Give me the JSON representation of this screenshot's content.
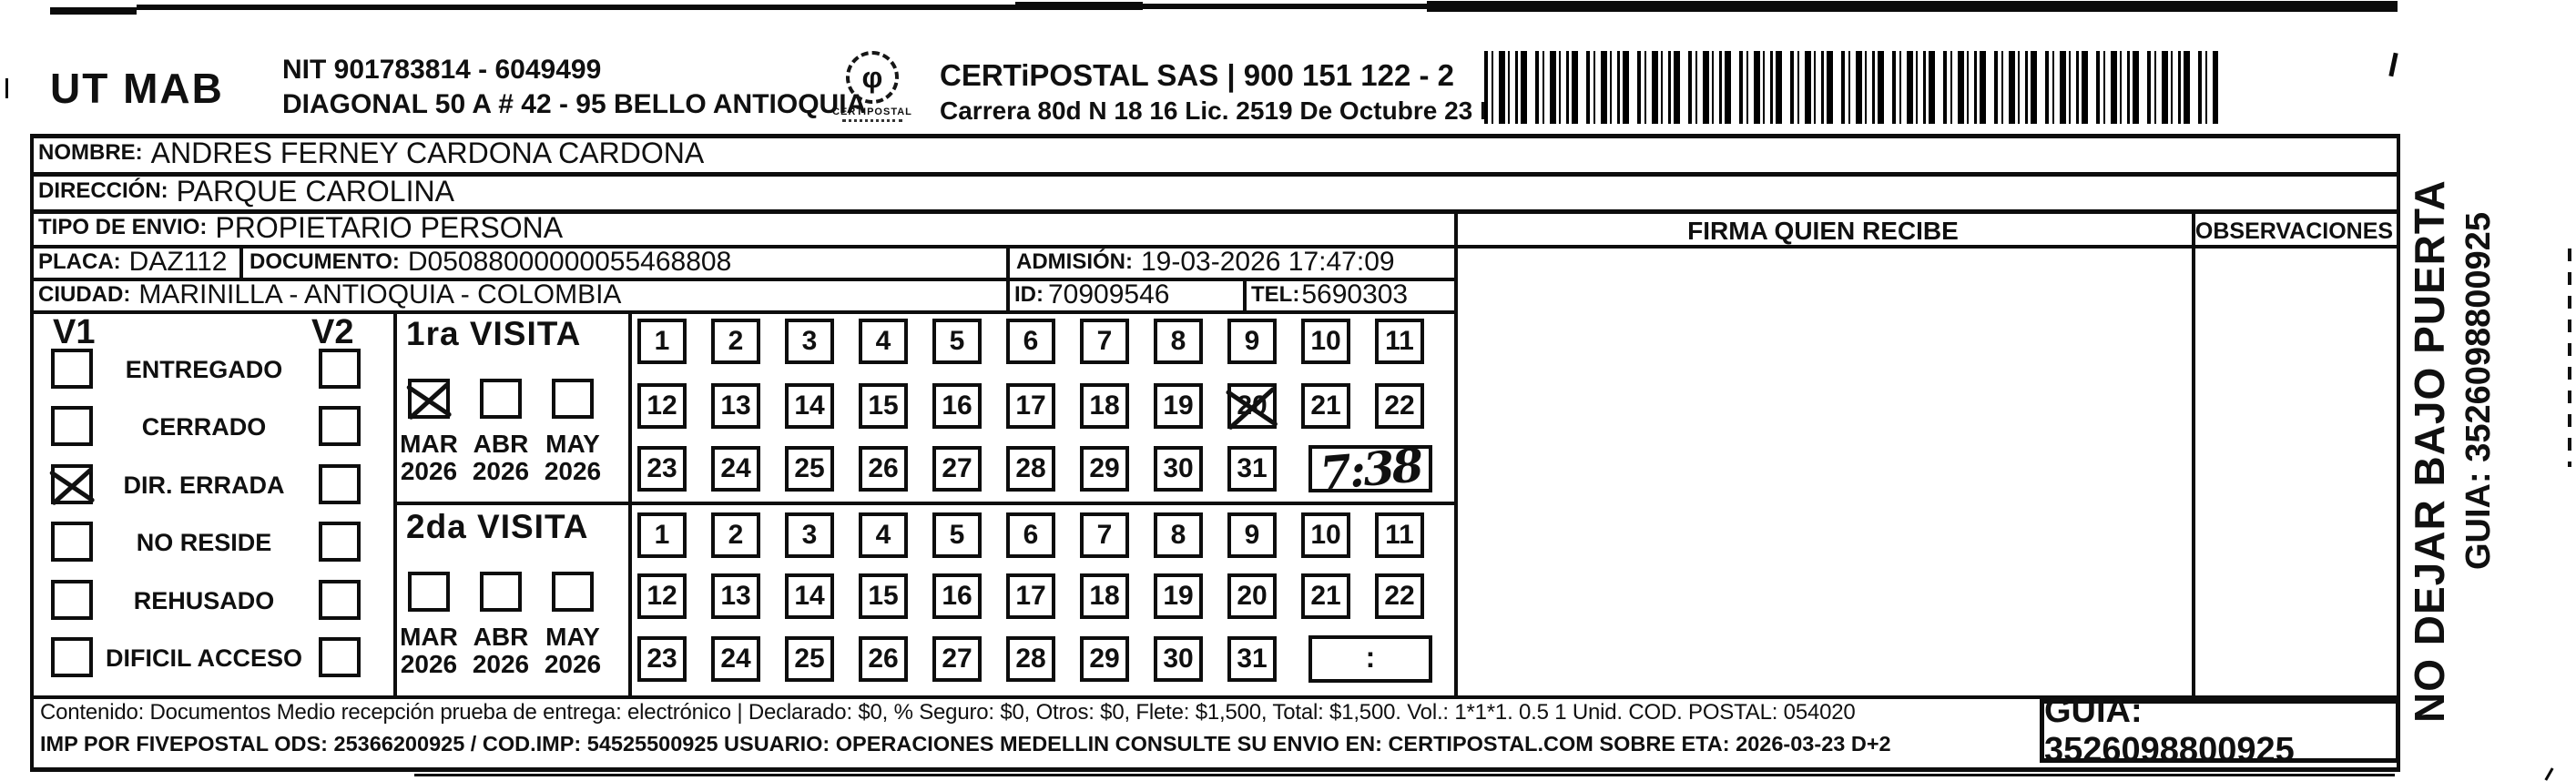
{
  "header": {
    "sender": "UT MAB",
    "nit": "NIT 901783814 - 6049499",
    "sender_address": "DIAGONAL 50 A # 42 - 95  BELLO  ANTIOQUIA",
    "logo_text": "CERTIPOSTAL",
    "company": "CERTiPOSTAL SAS | 900 151 122 - 2",
    "company_address": "Carrera 80d N 18 16  Lic. 2519 De Octubre 23 De 2015"
  },
  "fields": {
    "nombre": {
      "label": "NOMBRE:",
      "value": "ANDRES FERNEY CARDONA CARDONA"
    },
    "direccion": {
      "label": "DIRECCIÓN:",
      "value": "PARQUE CAROLINA"
    },
    "tipo_envio": {
      "label": "TIPO DE ENVIO:",
      "value": "PROPIETARIO PERSONA"
    },
    "placa": {
      "label": "PLACA:",
      "value": "DAZ112"
    },
    "documento": {
      "label": "DOCUMENTO:",
      "value": "D05088000000055468808"
    },
    "admision": {
      "label": "ADMISIÓN:",
      "value": "19-03-2026 17:47:09"
    },
    "ciudad": {
      "label": "CIUDAD:",
      "value": "MARINILLA - ANTIOQUIA - COLOMBIA"
    },
    "id": {
      "label": "ID:",
      "value": "70909546"
    },
    "tel": {
      "label": "TEL:",
      "value": "5690303"
    }
  },
  "columns": {
    "firma": "FIRMA QUIEN RECIBE",
    "observaciones": "OBSERVACIONES"
  },
  "status_panel": {
    "visit1_header": "V1",
    "visit2_header": "V2",
    "rows": [
      {
        "label": "ENTREGADO",
        "v1_checked": false,
        "v2_checked": false
      },
      {
        "label": "CERRADO",
        "v1_checked": false,
        "v2_checked": false
      },
      {
        "label": "DIR. ERRADA",
        "v1_checked": true,
        "v2_checked": false
      },
      {
        "label": "NO RESIDE",
        "v1_checked": false,
        "v2_checked": false
      },
      {
        "label": "REHUSADO",
        "v1_checked": false,
        "v2_checked": false
      },
      {
        "label": "DIFICIL ACCESO",
        "v1_checked": false,
        "v2_checked": false
      }
    ]
  },
  "visits": [
    {
      "title": "1ra VISITA",
      "months": [
        {
          "month": "MAR",
          "year": "2026",
          "checked": true
        },
        {
          "month": "ABR",
          "year": "2026",
          "checked": false
        },
        {
          "month": "MAY",
          "year": "2026",
          "checked": false
        }
      ],
      "day_rows": [
        [
          1,
          2,
          3,
          4,
          5,
          6,
          7,
          8,
          9,
          10,
          11
        ],
        [
          12,
          13,
          14,
          15,
          16,
          17,
          18,
          19,
          20,
          21,
          22
        ],
        [
          23,
          24,
          25,
          26,
          27,
          28,
          29,
          30,
          31
        ]
      ],
      "crossed_day": 20,
      "time_written": "7:38",
      "time_placeholder": null
    },
    {
      "title": "2da VISITA",
      "months": [
        {
          "month": "MAR",
          "year": "2026",
          "checked": false
        },
        {
          "month": "ABR",
          "year": "2026",
          "checked": false
        },
        {
          "month": "MAY",
          "year": "2026",
          "checked": false
        }
      ],
      "day_rows": [
        [
          1,
          2,
          3,
          4,
          5,
          6,
          7,
          8,
          9,
          10,
          11
        ],
        [
          12,
          13,
          14,
          15,
          16,
          17,
          18,
          19,
          20,
          21,
          22
        ],
        [
          23,
          24,
          25,
          26,
          27,
          28,
          29,
          30,
          31
        ]
      ],
      "crossed_day": null,
      "time_written": null,
      "time_placeholder": ":"
    }
  ],
  "side_text": {
    "line1": "NO DEJAR BAJO PUERTA",
    "line2": "GUIA: 3526098800925"
  },
  "footer": {
    "line1": "Contenido: Documentos Medio recepción prueba de entrega: electrónico | Declarado: $0, % Seguro: $0, Otros: $0, Flete: $1,500, Total: $1,500. Vol.: 1*1*1. 0.5  1 Unid. COD. POSTAL: 054020",
    "line2": "IMP POR FIVEPOSTAL ODS: 25366200925 / COD.IMP: 54525500925 USUARIO: OPERACIONES MEDELLIN CONSULTE SU ENVIO EN: CERTIPOSTAL.COM SOBRE ETA: 2026-03-23 D+2",
    "guia": "GUIA: 3526098800925"
  },
  "colors": {
    "ink": "#101010",
    "paper": "#ffffff"
  }
}
